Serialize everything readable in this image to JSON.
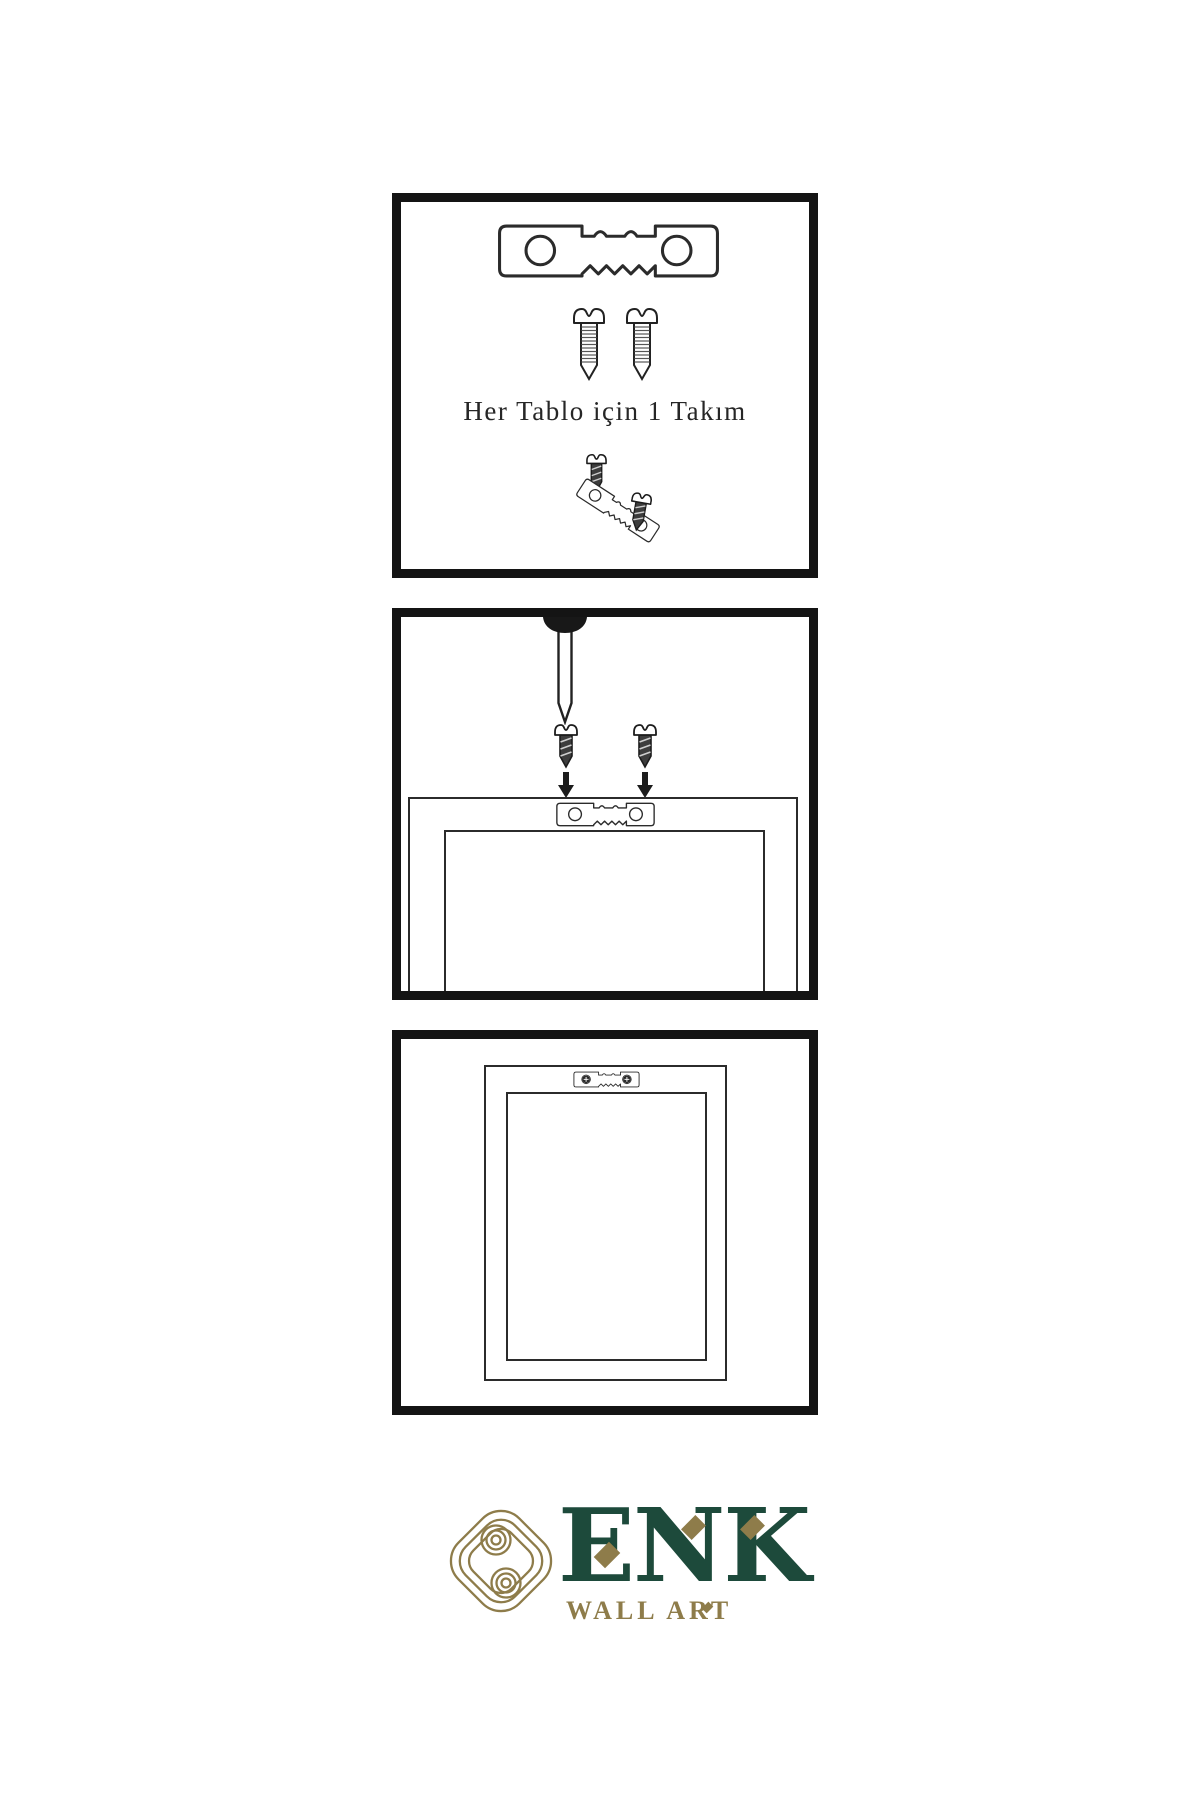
{
  "caption": {
    "text": "Her Tablo için 1 Takım"
  },
  "logo": {
    "wordmark": "ENK",
    "subtitle": "WALL ART",
    "green": "#1d4a3b",
    "gold": "#8e7c4a"
  },
  "palette": {
    "background": "#ffffff",
    "panel_border": "#141414",
    "line_art": "#2b2b2b"
  },
  "icons": {
    "hanger": "sawtooth-hanger-icon",
    "screw_light": "screw-icon",
    "screw_dark": "dark-screw-icon",
    "nail": "wall-nail-icon",
    "arrow": "arrow-down-icon",
    "knot": "knot-logo-icon"
  }
}
